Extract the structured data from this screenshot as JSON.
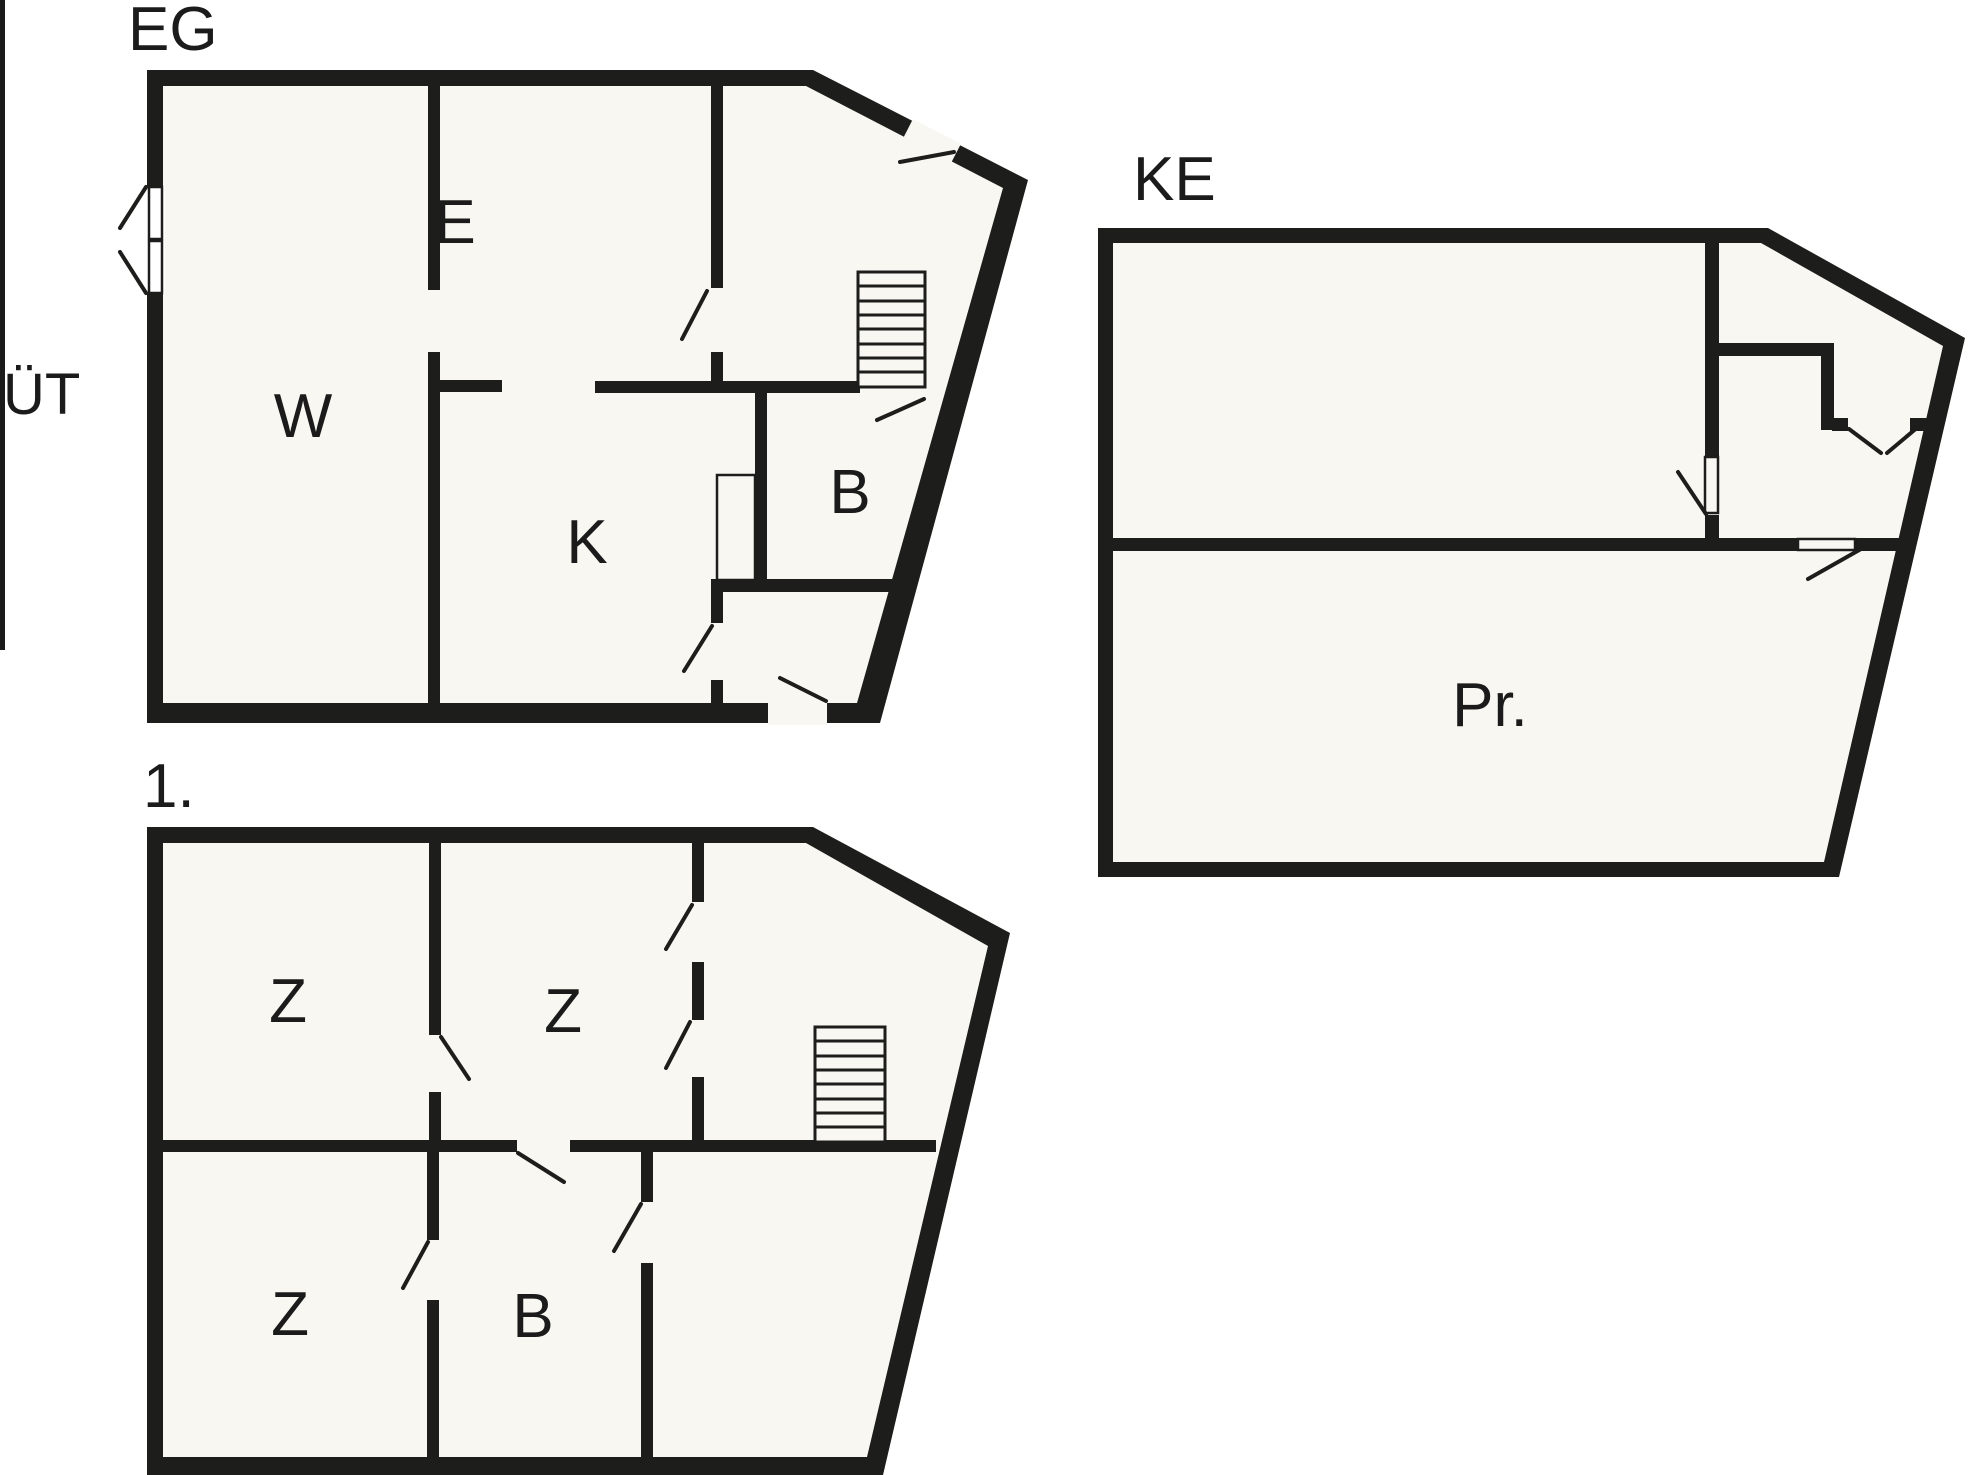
{
  "document": {
    "kind": "architectural floor plan drawing"
  },
  "colors": {
    "wall": "#1d1d1b",
    "floor": "#f8f7f2",
    "background": "#ffffff",
    "line": "#1d1d1b"
  },
  "plans": {
    "eg": {
      "title": "EG",
      "rooms": {
        "w": "W",
        "e": "E",
        "k": "K",
        "b": "B"
      }
    },
    "ke": {
      "title": "KE",
      "rooms": {
        "pr": "Pr."
      }
    },
    "first": {
      "title": "1.",
      "rooms": {
        "z1": "Z",
        "z2": "Z",
        "z3": "Z",
        "b": "B"
      }
    }
  },
  "exterior": {
    "ut_label": "ÜT"
  }
}
